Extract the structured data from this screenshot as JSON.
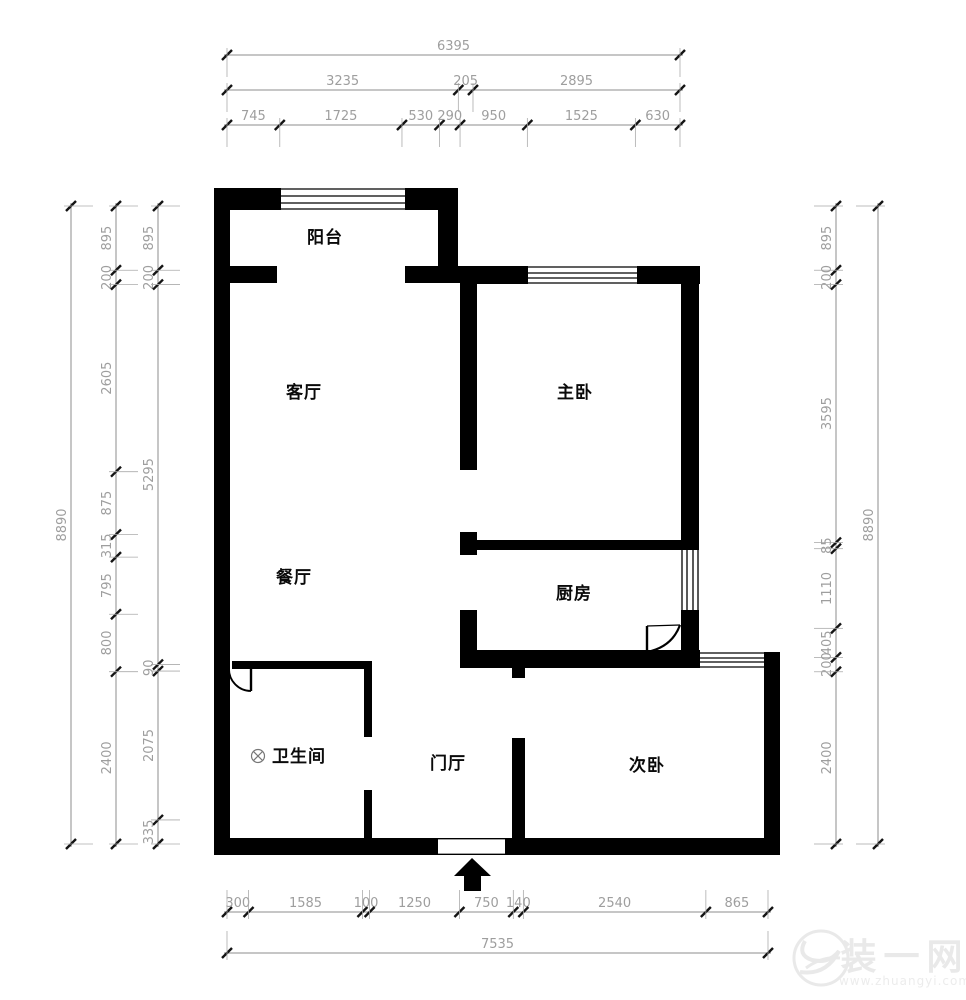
{
  "floor_plan": {
    "rooms": [
      {
        "id": "balcony",
        "label": "阳台"
      },
      {
        "id": "living-room",
        "label": "客厅"
      },
      {
        "id": "master-bedroom",
        "label": "主卧"
      },
      {
        "id": "dining-room",
        "label": "餐厅"
      },
      {
        "id": "kitchen",
        "label": "厨房"
      },
      {
        "id": "bathroom",
        "label": "卫生间"
      },
      {
        "id": "entry-hall",
        "label": "门厅"
      },
      {
        "id": "second-bedroom",
        "label": "次卧"
      }
    ],
    "dimensions": {
      "top": [
        {
          "values": [
            6395
          ]
        },
        {
          "values": [
            3235,
            205,
            2895
          ]
        },
        {
          "values": [
            745,
            1725,
            530,
            290,
            950,
            1525,
            630
          ]
        }
      ],
      "bottom": [
        {
          "values": [
            300,
            1585,
            100,
            1250,
            750,
            140,
            2540,
            865
          ]
        },
        {
          "values": [
            7535
          ]
        }
      ],
      "left": [
        {
          "values": [
            8890
          ]
        },
        {
          "values": [
            895,
            200,
            2605,
            875,
            315,
            795,
            800,
            2400
          ]
        },
        {
          "values": [
            895,
            200,
            5295,
            90,
            2075,
            335
          ]
        }
      ],
      "right": [
        {
          "values": [
            895,
            200,
            3595,
            85,
            1110,
            405,
            200,
            2400
          ]
        },
        {
          "values": [
            8890
          ]
        }
      ]
    },
    "symbols": {
      "entrance_arrow": "up-arrow",
      "floor_drain": "circle-x"
    },
    "watermark": {
      "brand": "装一网",
      "url": "www.zhuangyi.com"
    }
  },
  "colors": {
    "wall": "#000000",
    "dim_line": "#8c8c8c",
    "dim_text": "#9e9e9e",
    "tick": "#141414",
    "watermark": "#e9e9e9"
  }
}
